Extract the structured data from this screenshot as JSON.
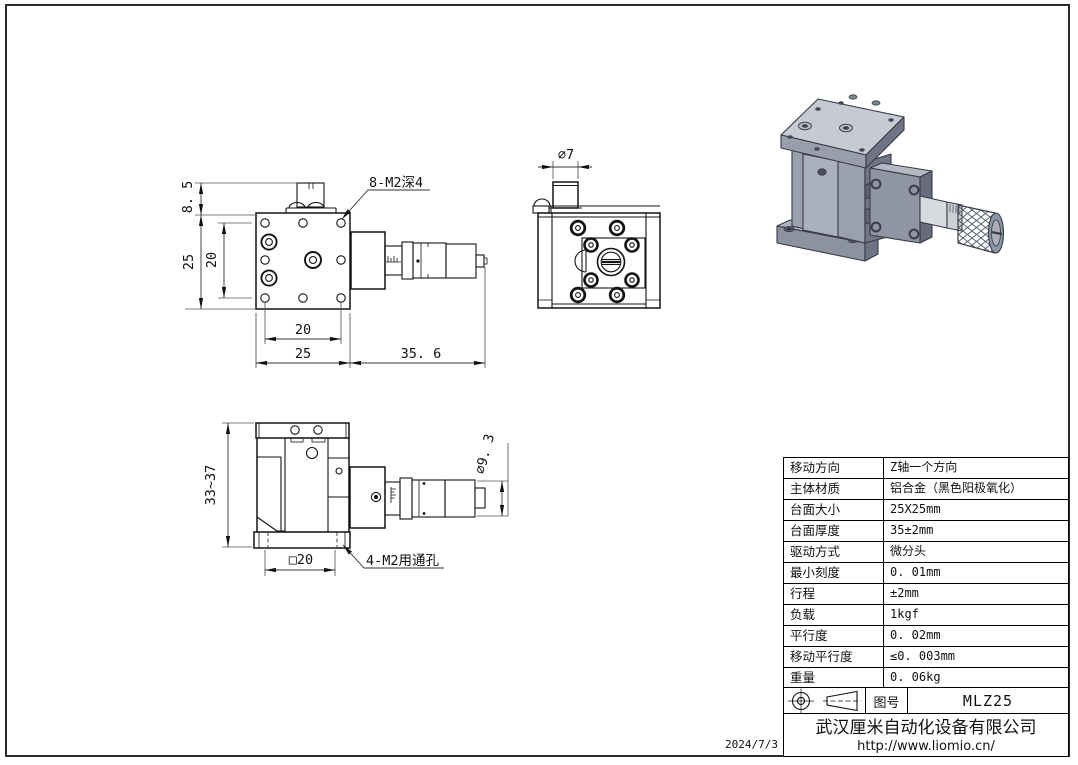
{
  "sheet": {
    "date": "2024/7/3"
  },
  "front_view": {
    "dim_8_5": "8. 5",
    "dim_25_left": "25",
    "dim_20_left": "20",
    "dim_20_bottom": "20",
    "dim_25_bottom": "25",
    "dim_35_6": "35. 6",
    "note_holes": "8-M2深4"
  },
  "side_view": {
    "dim_d7": "∅7"
  },
  "lower_view": {
    "dim_33_37": "33~37",
    "dim_sq20": "□20",
    "dim_d9_3": "∅9. 3",
    "note_holes": "4-M2用通孔"
  },
  "spec_table": {
    "rows": [
      {
        "label": "移动方向",
        "value": "Z轴一个方向"
      },
      {
        "label": "主体材质",
        "value": "铝合金（黑色阳极氧化）"
      },
      {
        "label": "台面大小",
        "value": "25X25mm"
      },
      {
        "label": "台面厚度",
        "value": "35±2mm"
      },
      {
        "label": "驱动方式",
        "value": "微分头"
      },
      {
        "label": "最小刻度",
        "value": "0. 01mm"
      },
      {
        "label": "行程",
        "value": "±2mm"
      },
      {
        "label": "负载",
        "value": "1kgf"
      },
      {
        "label": "平行度",
        "value": "0. 02mm"
      },
      {
        "label": "移动平行度",
        "value": "≤0. 003mm"
      },
      {
        "label": "重量",
        "value": "0. 06kg"
      }
    ]
  },
  "title_block": {
    "drawing_no_label": "图号",
    "drawing_no": "MLZ25",
    "company": "武汉厘米自动化设备有限公司",
    "website": "http://www.liomio.cn/"
  }
}
